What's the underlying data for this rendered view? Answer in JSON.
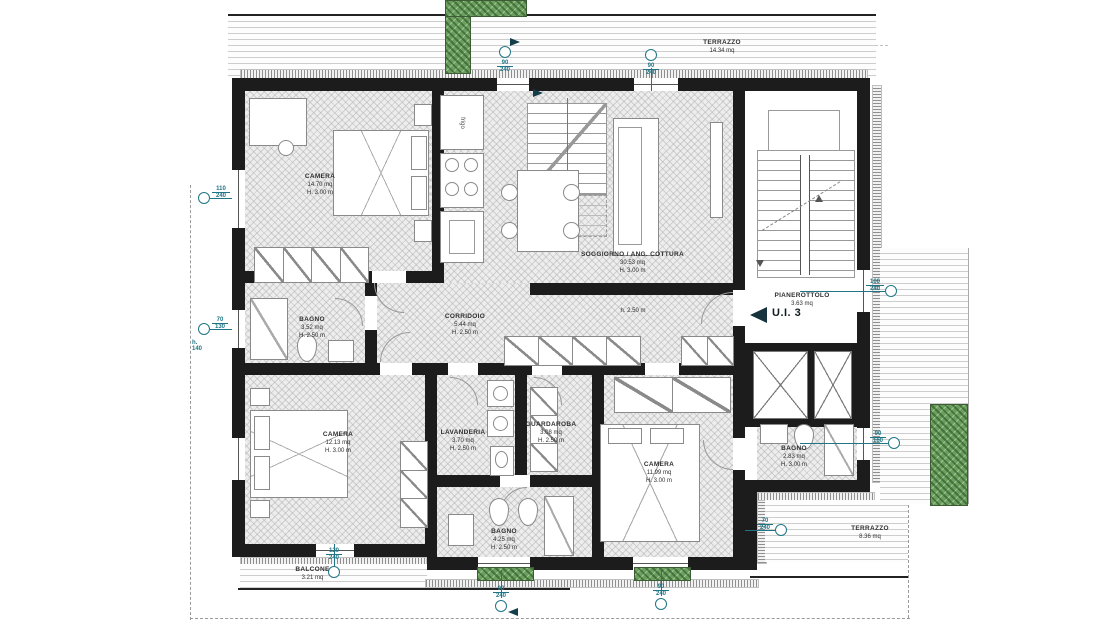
{
  "unit": {
    "label": "U.I. 3"
  },
  "rooms": {
    "camera1": {
      "name": "CAMERA",
      "area": "14.70 mq",
      "height": "H. 3.00 m"
    },
    "soggiorno": {
      "name": "SOGGIORNO / ANG. COTTURA",
      "area": "30.53 mq",
      "height": "H. 3.00 m"
    },
    "corridoio": {
      "name": "CORRIDOIO",
      "area": "5.44 mq",
      "height": "H. 2.50 m"
    },
    "bagno_nord": {
      "name": "BAGNO",
      "area": "3.52 mq",
      "height": "H. 2.50 m"
    },
    "camera2": {
      "name": "CAMERA",
      "area": "12.13 mq",
      "height": "H. 3.00 m"
    },
    "lavanderia": {
      "name": "LAVANDERIA",
      "area": "3.70 mq",
      "height": "H. 2.50 m"
    },
    "guardaroba": {
      "name": "GUARDAROBA",
      "area": "3.08 mq",
      "height": "H. 2.50 m"
    },
    "bagno_centrale": {
      "name": "BAGNO",
      "area": "4.25 mq",
      "height": "H. 2.50 m"
    },
    "camera3": {
      "name": "CAMERA",
      "area": "11.99 mq",
      "height": "H. 3.00 m"
    },
    "bagno_est": {
      "name": "BAGNO",
      "area": "2.83 mq",
      "height": "H. 3.00 m"
    },
    "pianerottolo": {
      "name": "PIANEROTTOLO",
      "area": "3.63 mq"
    },
    "terrazzo_nord": {
      "name": "TERRAZZO",
      "area": "14.34 mq"
    },
    "terrazzo_est": {
      "name": "TERRAZZO",
      "area": "8.36 mq"
    },
    "balcone": {
      "name": "BALCONE",
      "area": "3.21 mq"
    }
  },
  "annotations": {
    "corridor_height": "h. 2.50 m",
    "fridge": "frigo"
  },
  "dimension_markers": {
    "left_window_camera1": {
      "w": "110",
      "h": "240"
    },
    "left_window_bagno": {
      "w": "70",
      "h": "130",
      "sill": "h. 140"
    },
    "top_door_soggiorno": {
      "w": "90",
      "h": "240"
    },
    "top_window_soggiorno": {
      "w": "90",
      "h": "240"
    },
    "right_window_pianerottolo": {
      "w": "100",
      "h": "240"
    },
    "right_window_bagno": {
      "w": "90",
      "h": "160"
    },
    "terrace_window": {
      "w": "70",
      "h": "240"
    },
    "balcone_door": {
      "w": "120",
      "h": "240"
    },
    "bottom_window_1": {
      "w": "90",
      "h": "240"
    },
    "bottom_window_2": {
      "w": "90",
      "h": "240"
    }
  },
  "colors": {
    "wall": "#1c1c1c",
    "accent_teal": "#1f7585",
    "plant_green": "#6da05e",
    "floor_fill": "#ededed",
    "line_gray": "#8a8a8a"
  }
}
